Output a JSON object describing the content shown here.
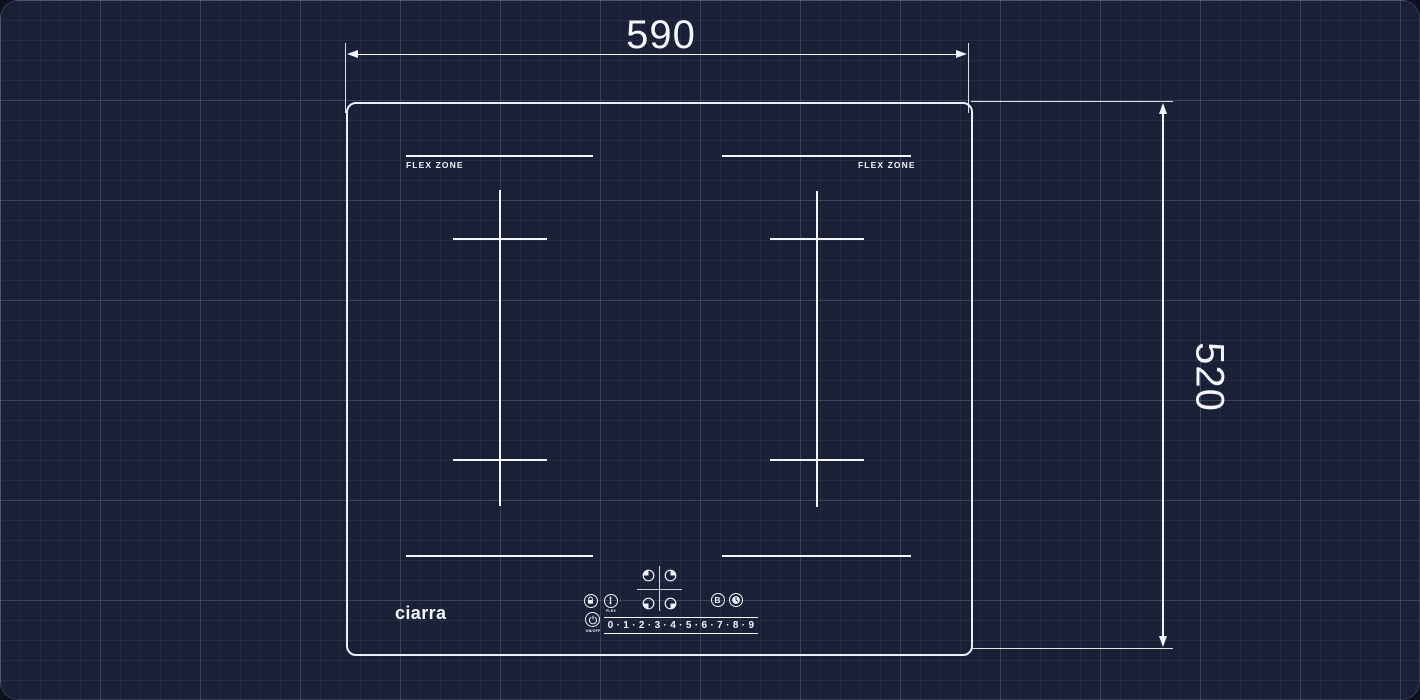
{
  "scene": {
    "type": "induction-hob-dimension-blueprint"
  },
  "dimensions": {
    "width_label": "590",
    "height_label": "520"
  },
  "hob": {
    "brand_logo": "ciarra",
    "flex_zone_left": "FLEX ZONE",
    "flex_zone_right": "FLEX ZONE"
  },
  "controls": {
    "boost_label": "B",
    "flex_label": "FLEX",
    "power_label": "ON/OFF",
    "power_levels": "0 · 1 · 2 · 3 · 4 · 5 · 6 · 7 · 8 · 9",
    "icons": {
      "lock": "child-lock-icon",
      "flex": "flex-bridge-arrows-icon",
      "timer": "timer-clock-icon",
      "power": "power-icon",
      "zone_selector": "quarter-filled-zone-icons"
    }
  },
  "colors": {
    "background": "#1a2036",
    "grid_line": "rgba(173,184,222,0.10)",
    "line": "#f2f5fb"
  }
}
